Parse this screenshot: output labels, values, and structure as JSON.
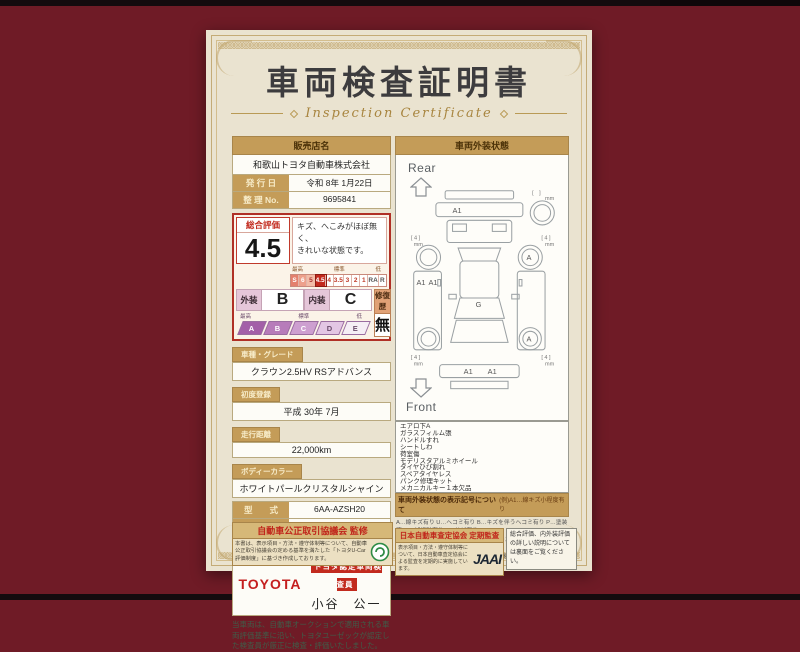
{
  "colors": {
    "background": "#6f1b26",
    "paper": "#eae3d0",
    "gold": "#c49c58",
    "red": "#c22a1e",
    "purple": "#a35fa8"
  },
  "title": "車両検査証明書",
  "subtitle": "Inspection Certificate",
  "seller": {
    "label": "販売店名",
    "name": "和歌山トヨタ自動車株式会社"
  },
  "issue_date": {
    "label": "発 行 日",
    "value": "令和 8年 1月22日"
  },
  "serial": {
    "label": "整 理 No.",
    "value": "9695841"
  },
  "rating": {
    "label": "総合評価",
    "score": "4.5",
    "comment1": "キズ、へこみがほぼ無く、",
    "comment2": "きれいな状態です。",
    "scale_high": "最高",
    "scale_mid": "標準",
    "scale_low": "低",
    "scale": [
      "S",
      "6",
      "5",
      "4.5",
      "4",
      "3.5",
      "3",
      "2",
      "1",
      "RA",
      "R"
    ],
    "selected": "4.5",
    "exterior_label": "外装",
    "exterior_grade": "B",
    "interior_label": "内装",
    "interior_grade": "C",
    "repair_label": "修復歴",
    "repair_value": "無",
    "grades": [
      "A",
      "B",
      "C",
      "D",
      "E"
    ]
  },
  "details": {
    "model": {
      "label": "車種・グレード",
      "value": "クラウン2.5HV RSアドバンス"
    },
    "first_reg": {
      "label": "初度登録",
      "value": "平成 30年 7月"
    },
    "mileage": {
      "label": "走行距離",
      "value": "22,000km"
    },
    "body_color": {
      "label": "ボディーカラー",
      "value": "ホワイトパールクリスタルシャイン"
    },
    "model_code": {
      "label": "型　　式",
      "value": "6AA-AZSH20"
    },
    "chassis_no": {
      "label": "車台番号",
      "value": "XXXXXXX852"
    },
    "engine": {
      "label": "エンジン",
      "value": "ハイブリッド"
    }
  },
  "inspector": {
    "brand": "TOYOTA",
    "badge": "トヨタ認定車両検査員",
    "name": "小谷　公一"
  },
  "disclaimer": "当車両は、自動車オークションで適用される車両評価基準に沿い、トヨタユーゼックが認定した検査員が厳正に検査・評価いたしました。",
  "exterior_panel": {
    "header": "車両外装状態",
    "rear_label": "Rear",
    "front_label": "Front",
    "marks": {
      "a1": "A1",
      "g": "G",
      "a": "A",
      "mm4": "[ 4 ]",
      "mm": "mm",
      "mm_empty": "[　]"
    },
    "notes": [
      "エアロ下A",
      "ガラスフィルム張",
      "ハンドルすれ",
      "シートしわ",
      "荷室傷",
      "モデリスタアルミホイール",
      "タイヤひび割れ",
      "スペアタイヤレス",
      "パンク修理キット",
      "メカニカルキー１本欠品"
    ],
    "legend_title": "車両外装状態の表示記号について",
    "legend_example": "(例)A1…線キズ小程度有り",
    "legend_lines": [
      "A…線キズ有り U…ヘコミ有り B…キズを伴うヘコミ有り P…塗装済 W…補修跡有り S…サビ有り",
      "C…腐食有り G…フロントガラス飛び石キズ有り X…要交換(裏面に補足有り) XX…交換済",
      "1…小程度 2…中程度 3…大程度 ※タイヤ横の数字は、溝の深さを示します。"
    ]
  },
  "footer": {
    "council": {
      "title": "自動車公正取引協議会 監修",
      "text": "本書は、表示項目・方法・遵守体制等について、自動車公正取引協議会の定める基準を満たした「トヨタU-Car評価制度」に基づき作成しております。"
    },
    "jaai": {
      "title": "日本自動車査定協会 定期監査",
      "text": "表示項目・方法・遵守体制等について、日本自動車査定協会による監査を定期的に実施しています。",
      "logo": "JAAI"
    },
    "note": "総合評価、内外装評価の詳しい説明については裏面をご覧ください。"
  }
}
